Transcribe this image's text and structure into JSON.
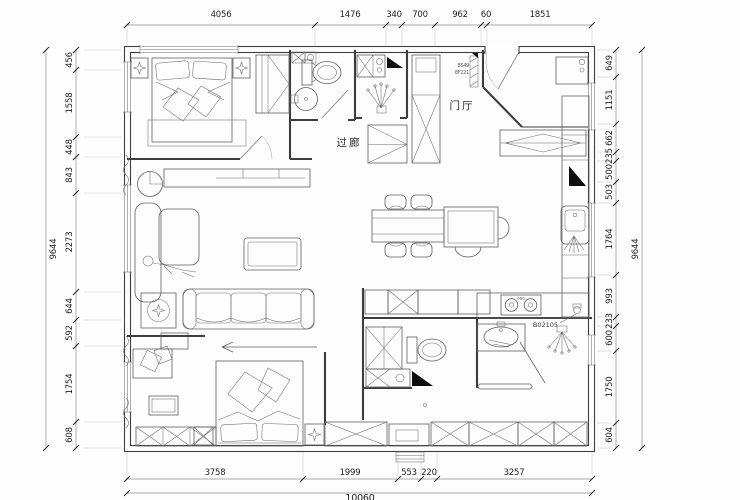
{
  "dims": {
    "top": [
      "4056",
      "1476",
      "340",
      "700",
      "962",
      "60",
      "1851"
    ],
    "bottom": [
      "3758",
      "1999",
      "553",
      "220",
      "3257"
    ],
    "bottom_total": "10060",
    "left": [
      "456",
      "1558",
      "448",
      "843",
      "2273",
      "644",
      "592",
      "1754",
      "608"
    ],
    "left_total": "9644",
    "right": [
      "649",
      "1151",
      "662",
      "235",
      "500",
      "503",
      "1764",
      "993",
      "233",
      "600",
      "1750",
      "604"
    ],
    "right_total": "9644"
  },
  "rooms": {
    "corridor": "过廊",
    "foyer": "门厅"
  },
  "annotations": {
    "appliance_tag": "B02105",
    "door_tag_top": "8549",
    "door_tag_bottom": "8F221"
  },
  "colors": {
    "wall": "#3d3d3d",
    "furniture": "#5f5f5f",
    "dim_line": "#8c8c8c",
    "dim_text": "#222222",
    "marker_fill": "#0d0d0d",
    "background": "#ffffff"
  }
}
